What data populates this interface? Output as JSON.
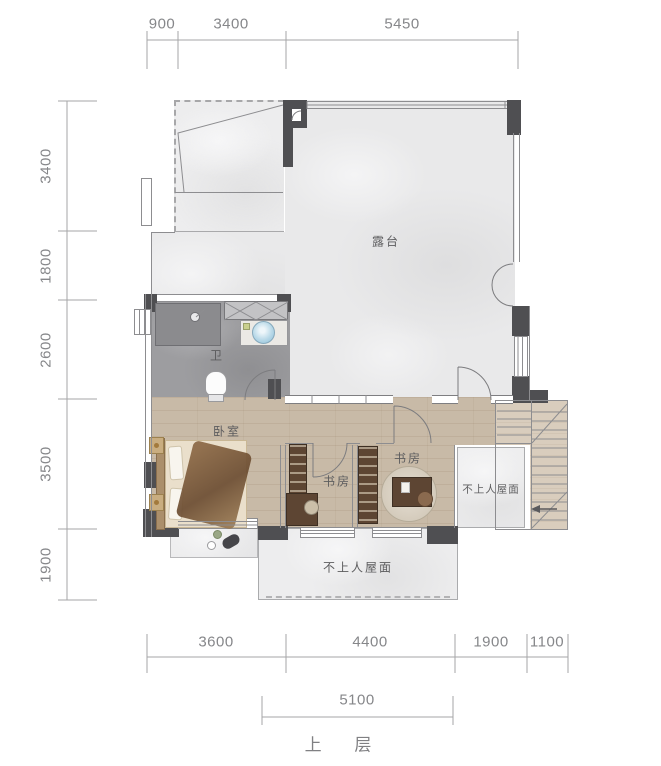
{
  "title": "上 层",
  "dims": {
    "top": [
      "900",
      "3400",
      "5450"
    ],
    "left": [
      "3400",
      "1800",
      "2600",
      "3500",
      "1900"
    ],
    "bottom": [
      "3600",
      "4400",
      "1900",
      "1100"
    ],
    "bottom2": [
      "5100"
    ]
  },
  "rooms": {
    "terrace": "露台",
    "bathroom": "卫",
    "bedroom": "卧室",
    "study_left": "书房",
    "study_right": "书房",
    "roof_right": "不上人屋面",
    "roof_bottom": "不上人屋面"
  },
  "colors": {
    "wall_dark": "#4f4f52",
    "wood_floor": "#c8baa7",
    "bath_floor": "#9d9da0",
    "marble_floor": "#e9e9ea",
    "stair_floor": "#d9cdbd",
    "shelf_brown": "#5d4533",
    "basin_blue": "#8abcd8",
    "dim_text": "#86878a",
    "label_text": "#5c5c5e"
  }
}
